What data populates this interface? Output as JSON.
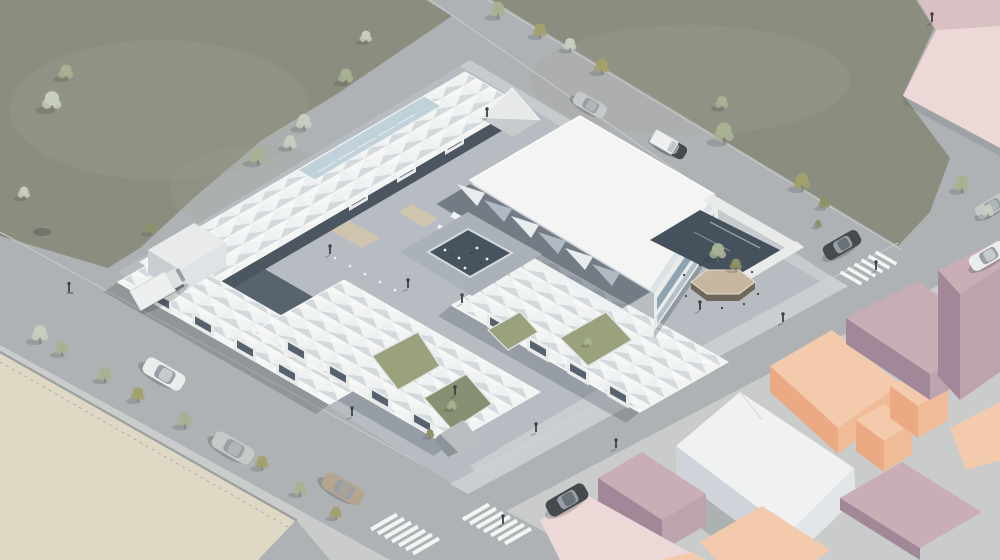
{
  "meta": {
    "kind": "architectural-aerial-rendering",
    "view": "isometric axonometric bird's-eye",
    "subject": "public market hall complex with white folded-plate canopy roofs around a sunken courtyard, large flat roof canopy over east hall, surrounded by streets, lawns, a vacant sand lot and pastel context buildings",
    "canvas": {
      "width": 1000,
      "height": 560
    },
    "visible_text": "none"
  },
  "colors": {
    "road": "#aeb2b5",
    "road_edge": "#c6c9c8",
    "curb": "#9aa09e",
    "sidewalk": "#c9cccb",
    "lot_sand": "#ded8c5",
    "grass": "#8b8e7f",
    "grass_light": "#a3a694",
    "site_paving": "#b6bcc1",
    "walkway": "#cdd1d3",
    "site_shadow": "#57636f",
    "courtyard_dark": "#47545f",
    "concrete": "#ced3d3",
    "grass_patch": "#99a17d",
    "grass_patch_dark": "#879072",
    "planter_top": "#c6b79e",
    "planter_side": "#6f675a",
    "kiosk_tan": "#cfc5ae",
    "roof_white": "#f4f5f3",
    "roof_lit": "#f7f8f6",
    "roof_shade": "#d3dade",
    "roof_edge": "#e8ebec",
    "wall_white": "#e9ebeb",
    "wall_shade": "#c6cdd3",
    "glass": "#bed0da",
    "glass_dark": "#7e95a5",
    "pink_top": "#d9c0c3",
    "pink_face": "#ecd9d7",
    "peach_top": "#f3caac",
    "peach_sw": "#eba984",
    "peach_se": "#f0bb97",
    "mauve_top": "#c9aeb5",
    "mauve_sw": "#a28799",
    "mauve_se": "#bca3ad",
    "white_top": "#f0f1f1",
    "white_left": "#ced4da",
    "white_right": "#e3e6e9",
    "car_dark": "#454a4e",
    "car_silver": "#c7c9c9",
    "car_white": "#ebecec",
    "car_beige": "#b5a58f",
    "car_glass": "#97a0a6",
    "truck_white": "#eef0f0",
    "tree_sage": "#a9b194",
    "tree_olive": "#8d9166",
    "tree_pale": "#c7cdbf",
    "tree_khaki": "#a3a06b",
    "person": "#3c4248",
    "zebra": "#f4f5f5",
    "shadow": "#3d4750"
  },
  "scene": {
    "terrain": [
      {
        "name": "meadow-west",
        "type": "lawn",
        "position": "upper left"
      },
      {
        "name": "meadow-east",
        "type": "lawn wedge",
        "position": "upper right"
      },
      {
        "name": "vacant-sand-lot",
        "type": "empty plot",
        "position": "lower left"
      },
      {
        "name": "paved-block",
        "type": "sidewalk ground",
        "position": "lower right"
      }
    ],
    "roads": [
      {
        "name": "southwest-street",
        "direction": "down-right",
        "features": [
          "street trees",
          "parked traffic"
        ]
      },
      {
        "name": "northeast-street",
        "direction": "down-right",
        "features": [
          "two cars"
        ]
      },
      {
        "name": "cross-street",
        "direction": "down-left",
        "features": [
          "two intersections",
          "zebra crossings"
        ]
      }
    ],
    "crosswalks": {
      "count": 3,
      "locations": [
        "south intersection west arm",
        "south intersection east arm",
        "east intersection"
      ]
    },
    "market_complex": {
      "roofs": [
        "folded-plate northwest wing with glazed ridge skylight",
        "folded-plate west wing",
        "two folded-plate south halls",
        "large flat canopy over east hall"
      ],
      "features": [
        "sunken central courtyard with seating",
        "tensile shade sails under flat canopy",
        "glass gabled kiosks",
        "market stall arcades",
        "hexagonal tree planter plaza",
        "concrete pyramid landform",
        "angular planted south-east plaza",
        "bollards and street furniture"
      ]
    },
    "context_buildings": {
      "style": "flat pastel massing blocks",
      "blocks": [
        "pale pink slab (top right)",
        "white block",
        "peach block",
        "two peach towers",
        "two mauve blocks",
        "mauve low block",
        "pale pink low slab",
        "partial edge blocks"
      ]
    },
    "vehicles": [
      {
        "type": "car",
        "color": "car_white",
        "on": "southwest-street"
      },
      {
        "type": "car",
        "color": "car_silver",
        "on": "southwest-street"
      },
      {
        "type": "car",
        "color": "car_beige",
        "on": "southwest-street"
      },
      {
        "type": "car",
        "color": "car_dark",
        "on": "cross-street near south intersection"
      },
      {
        "type": "car",
        "color": "car_silver",
        "on": "northeast-street"
      },
      {
        "type": "car",
        "color": "car_dark",
        "on": "northeast-street"
      },
      {
        "type": "car",
        "color": "car_dark",
        "on": "cross-street east"
      },
      {
        "type": "car",
        "color": "car_white",
        "on": "cross-street right edge"
      },
      {
        "type": "car",
        "color": "car_silver",
        "on": "cross-street right edge"
      },
      {
        "type": "box-truck",
        "color": "truck_white",
        "on": "southwest-street at market west corner"
      },
      {
        "type": "van",
        "color": "truck_white",
        "on": "service plaza by flat canopy"
      },
      {
        "type": "cyclist",
        "color": "person",
        "on": "southwest-street"
      }
    ],
    "trees": {
      "count": 33,
      "palette": [
        "tree_sage",
        "tree_olive",
        "tree_pale",
        "tree_khaki"
      ]
    },
    "pedestrians": {
      "count": 13
    }
  }
}
